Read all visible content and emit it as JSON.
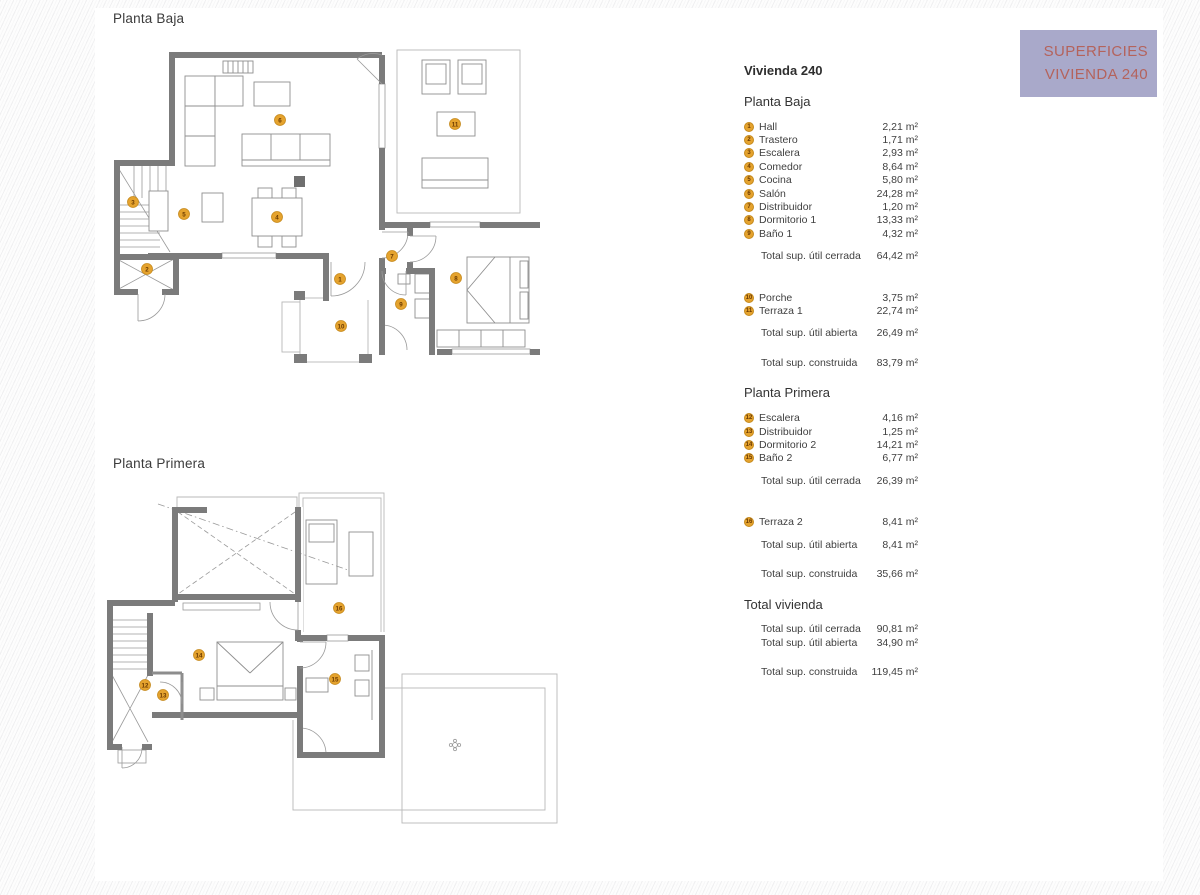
{
  "banner": {
    "line1": "SUPERFICIES",
    "line2": "VIVIENDA 240",
    "bg_color": "#a9a9ca",
    "text_color": "#b4635c"
  },
  "marker_style": {
    "fill": "#e5a32e",
    "border": "#c68a1d",
    "number_color": "#6b3a00"
  },
  "plans": [
    {
      "id": "planta-baja",
      "title": "Planta Baja",
      "markers": [
        {
          "n": "1",
          "x": 230,
          "y": 239
        },
        {
          "n": "2",
          "x": 37,
          "y": 229
        },
        {
          "n": "3",
          "x": 23,
          "y": 162
        },
        {
          "n": "4",
          "x": 167,
          "y": 177
        },
        {
          "n": "5",
          "x": 74,
          "y": 174
        },
        {
          "n": "6",
          "x": 170,
          "y": 80
        },
        {
          "n": "7",
          "x": 282,
          "y": 216
        },
        {
          "n": "8",
          "x": 346,
          "y": 238
        },
        {
          "n": "9",
          "x": 291,
          "y": 264
        },
        {
          "n": "10",
          "x": 231,
          "y": 286
        },
        {
          "n": "11",
          "x": 345,
          "y": 84
        }
      ]
    },
    {
      "id": "planta-primera",
      "title": "Planta Primera",
      "markers": [
        {
          "n": "12",
          "x": 45,
          "y": 195
        },
        {
          "n": "13",
          "x": 63,
          "y": 205
        },
        {
          "n": "14",
          "x": 99,
          "y": 165
        },
        {
          "n": "15",
          "x": 235,
          "y": 189
        },
        {
          "n": "16",
          "x": 239,
          "y": 118
        }
      ]
    }
  ],
  "legend": {
    "title": "Vivienda 240",
    "sections": [
      {
        "heading": "Planta Baja",
        "rooms": [
          {
            "n": "1",
            "label": "Hall",
            "value": "2,21 m²"
          },
          {
            "n": "2",
            "label": "Trastero",
            "value": "1,71 m²"
          },
          {
            "n": "3",
            "label": "Escalera",
            "value": "2,93 m²"
          },
          {
            "n": "4",
            "label": "Comedor",
            "value": "8,64 m²"
          },
          {
            "n": "5",
            "label": "Cocina",
            "value": "5,80 m²"
          },
          {
            "n": "6",
            "label": "Salón",
            "value": "24,28 m²"
          },
          {
            "n": "7",
            "label": "Distribuidor",
            "value": "1,20 m²"
          },
          {
            "n": "8",
            "label": "Dormitorio 1",
            "value": "13,33 m²"
          },
          {
            "n": "9",
            "label": "Baño 1",
            "value": "4,32 m²"
          }
        ],
        "total_cerrada": {
          "label": "Total sup. útil cerrada",
          "value": "64,42 m²"
        },
        "open_rooms": [
          {
            "n": "10",
            "label": "Porche",
            "value": "3,75 m²"
          },
          {
            "n": "11",
            "label": "Terraza 1",
            "value": "22,74 m²"
          }
        ],
        "total_abierta": {
          "label": "Total sup. útil abierta",
          "value": "26,49 m²"
        },
        "total_construida": {
          "label": "Total sup. construida",
          "value": "83,79 m²"
        }
      },
      {
        "heading": "Planta Primera",
        "rooms": [
          {
            "n": "12",
            "label": "Escalera",
            "value": "4,16 m²"
          },
          {
            "n": "13",
            "label": "Distribuidor",
            "value": "1,25 m²"
          },
          {
            "n": "14",
            "label": "Dormitorio 2",
            "value": "14,21 m²"
          },
          {
            "n": "15",
            "label": "Baño 2",
            "value": "6,77 m²"
          }
        ],
        "total_cerrada": {
          "label": "Total sup. útil cerrada",
          "value": "26,39 m²"
        },
        "open_rooms": [
          {
            "n": "16",
            "label": "Terraza 2",
            "value": "8,41 m²"
          }
        ],
        "total_abierta": {
          "label": "Total sup. útil abierta",
          "value": "8,41 m²"
        },
        "total_construida": {
          "label": "Total sup. construida",
          "value": "35,66 m²"
        }
      }
    ],
    "total_section": {
      "heading": "Total vivienda",
      "rows": [
        {
          "label": "Total sup. útil cerrada",
          "value": "90,81 m²"
        },
        {
          "label": "Total sup. útil abierta",
          "value": "34,90 m²"
        },
        {
          "label": "Total sup. construida",
          "value": "119,45 m²"
        }
      ]
    }
  }
}
